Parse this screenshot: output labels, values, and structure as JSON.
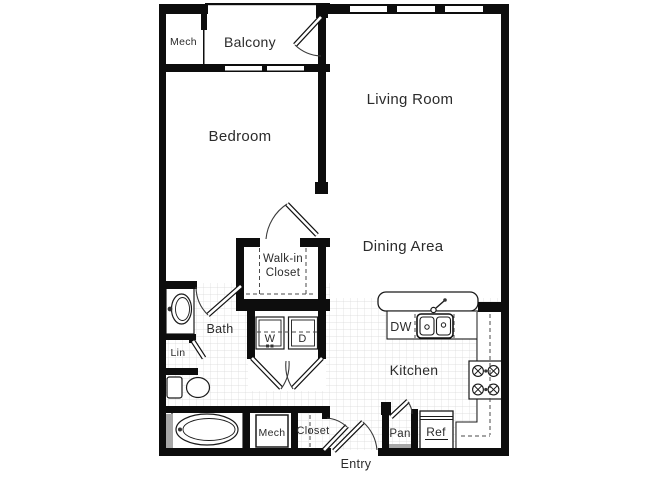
{
  "colors": {
    "wall": "#0d0d0d",
    "grid_line": "#d8d8d8",
    "label_text": "#2b2b2b",
    "door_shade": "#a8a8a8",
    "background": "#ffffff"
  },
  "floor_plan": {
    "labels": {
      "mech_top": "Mech",
      "balcony": "Balcony",
      "living_room": "Living Room",
      "bedroom": "Bedroom",
      "walk_in_closet_line1": "Walk-in",
      "walk_in_closet_line2": "Closet",
      "dining_area": "Dining Area",
      "bath": "Bath",
      "linen": "Lin",
      "washer": "W",
      "dryer": "D",
      "dishwasher": "DW",
      "kitchen": "Kitchen",
      "mech_bottom": "Mech",
      "closet": "Closet",
      "pantry": "Pan",
      "refrigerator": "Ref",
      "entry": "Entry"
    }
  }
}
